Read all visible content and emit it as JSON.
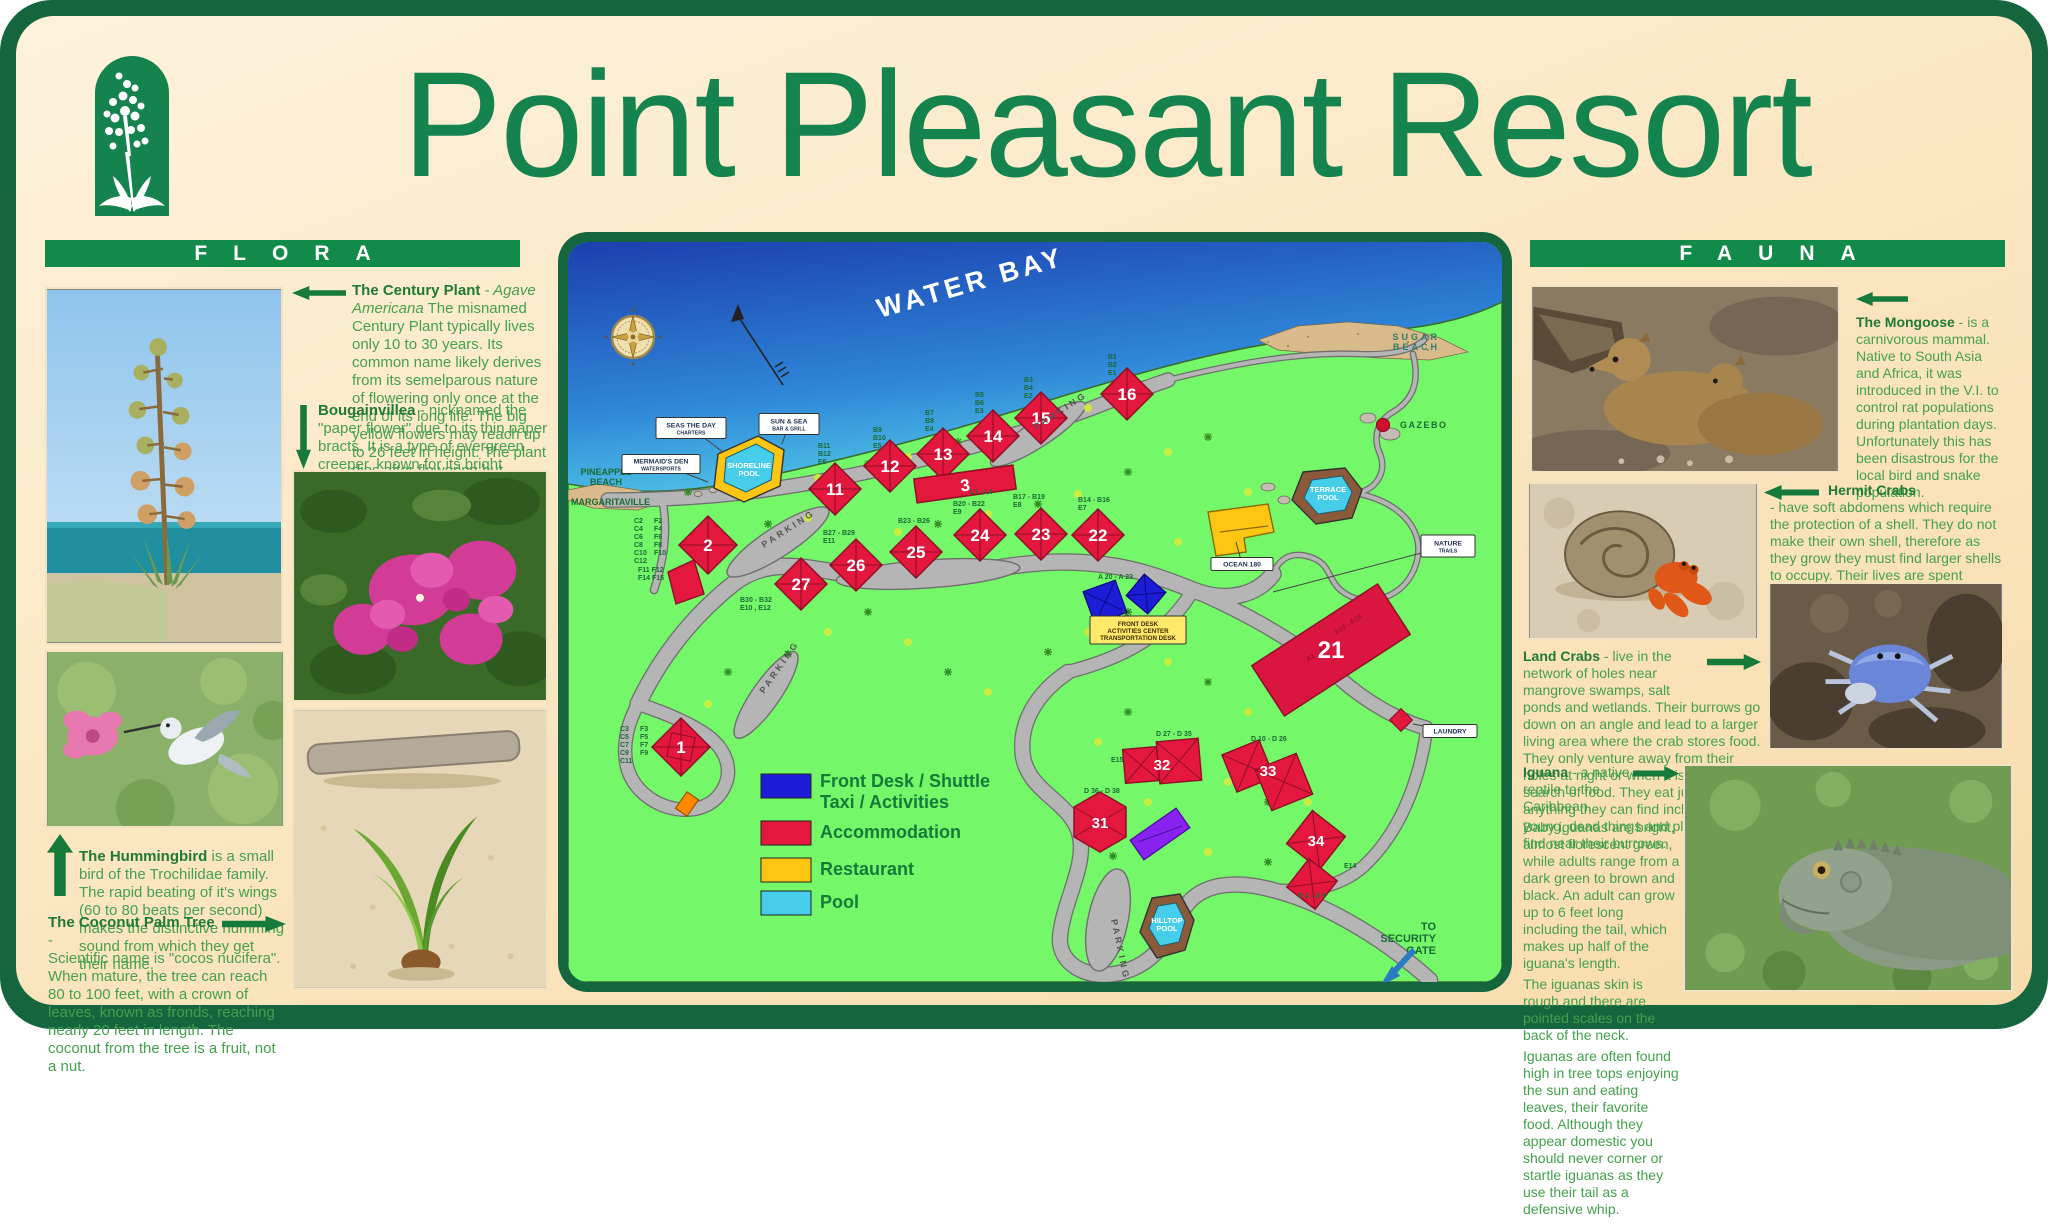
{
  "title": "Point Pleasant Resort",
  "colors": {
    "sign_green": "#15834e",
    "panel_cream": "#fbe7c4",
    "map_grass": "#74f768",
    "accommodation_red": "#e4173f",
    "front_desk_blue": "#1d1dd8",
    "restaurant_yellow": "#ffc513",
    "pool_cyan": "#45cdea"
  },
  "flora": {
    "heading": "FLORA",
    "century": {
      "name": "The Century Plant",
      "sci": "- Agave Americana",
      "body": "The misnamed Century Plant typically lives only 10 to 30 years. Its common name likely derives from its semelparous nature of flowering only once at the end of its long life. The big yellow flowers may reach up to 26 feet in height. The plant dies after flowering but produces adventitious shoots from the base, which continue its growth."
    },
    "bougainvillea": {
      "name": "Bougainvillea",
      "body": "- nicknamed the \"paper flower\" due to its thin paper bracts. It is a type of evergreen creeper, known for its bright blooms. With as many as 300 species, Bougainvillea thrives in sunlight, in tropical and subtropical conditions."
    },
    "hummingbird": {
      "name": "The Hummingbird",
      "body": "is a small bird of the Trochilidae family. The rapid beating of it's wings (60 to 80 beats per second) makes the distinctive humming sound from which they get their name."
    },
    "coconut": {
      "name": "The Coconut Palm Tree",
      "dash": "-",
      "body": "Scientific name is \"cocos nucifera\". When mature, the tree can reach 80 to 100 feet, with a crown of leaves, known as fronds, reaching nearly 20 feet in length. The coconut from the tree is a fruit, not a nut."
    }
  },
  "fauna": {
    "heading": "FAUNA",
    "mongoose": {
      "name": "The Mongoose",
      "body": "- is a carnivorous mammal. Native to South Asia and Africa, it was introduced in the V.I. to control rat populations during plantation days. Unfortunately this has been disastrous for the local bird and snake population."
    },
    "hermit": {
      "name": "Hermit Crabs",
      "body": "- have soft abdomens which require the protection of a shell. They do not make their own shell, therefore as they grow they must find larger shells to occupy. Their lives are spent  searching for and occupying shells of other animals. They are scavengers and their diet is varied - dead fish, algae, seaweeds, decaying fruit."
    },
    "landcrab": {
      "name": "Land Crabs",
      "body": "- live in the network of holes near mangrove swamps, salt ponds and wetlands. Their burrows go down on an angle and lead to a larger living area where the crab stores food. They only venture away from their holes at night or when it is raining in search of food. They eat just about anything they can find including their young, dead things and plants they find near their burrows."
    },
    "iguana": {
      "name": "Iguana",
      "intro": "- a native reptile to the Caribbean.",
      "p1": "Baby iguanas are bright, almost florescent green, while adults range from a dark green to brown and black. An adult  can grow up to 6 feet long including the tail, which makes up half of the iguana's length.",
      "p2": "The iguanas skin is rough and there are pointed scales on the back of the neck.",
      "p3": "Iguanas are often found high in tree tops enjoying the sun and eating leaves, their favorite food. Although they appear domestic you should never corner or startle iguanas as they use their tail as a defensive whip."
    }
  },
  "map": {
    "water_label": "WATER BAY",
    "diamond_numbers": [
      "11",
      "12",
      "13",
      "14",
      "15",
      "16",
      "22",
      "23",
      "24",
      "25",
      "26",
      "27",
      "2",
      "1"
    ],
    "rect_numbers": [
      "3",
      "21"
    ],
    "cluster_numbers": [
      "31",
      "32",
      "33",
      "34"
    ],
    "building21_units": [
      "A10 - A19",
      "A1 - A9"
    ],
    "unit_labels": [
      "B11\nB12\nE6",
      "B9\nB10\nE5",
      "B7\nB8\nE4",
      "B5\nB6\nE3",
      "B3\nB4\nE2",
      "B1\nB2\nE1",
      "L1 - L4",
      "B20 - B22\nE9",
      "B17 - B19\nE8",
      "B14 - B16\nE7",
      "B23 - B26",
      "B27 - B29\nE11",
      "B30 - B32\nE10 , E12",
      "C2\nC4\nC6\nC8\nC10\nC12",
      "F2\nF4\nF6\nF8\nF10",
      "F11  F12\nF14  F15",
      "C3\nC5\nC7\nC9\nC11",
      "F3\nF5\nF7\nF9",
      "A 20 - A 23",
      "D 27 - D 35",
      "D 10 - D 26",
      "E15",
      "D 36 - D 38",
      "E14",
      "D 1 - D 9"
    ],
    "place_labels": {
      "sugar_beach": "SUGAR\nBEACH",
      "pineapple_beach": "PINEAPPLE\nBEACH",
      "margaritaville": "MARGARITAVILLE",
      "gazebo": "GAZEBO",
      "parking": "PARKING",
      "security": "TO\nSECURITY\nGATE"
    },
    "boxes": {
      "seas": [
        "SEAS THE DAY",
        "CHARTERS"
      ],
      "sunsea": [
        "SUN & SEA",
        "BAR & GRILL"
      ],
      "mermaid": [
        "MERMAID'S DEN",
        "WATERSPORTS"
      ],
      "ocean180": [
        "OCEAN 180"
      ],
      "nature": [
        "NATURE",
        "TRAILS"
      ],
      "laundry": [
        "LAUNDRY"
      ],
      "frontdesk": [
        "FRONT DESK",
        "ACTIVITIES CENTER",
        "TRANSPORTATION DESK"
      ]
    },
    "pools": [
      "SHORELINE\nPOOL",
      "TERRACE\nPOOL",
      "HILLTOP\nPOOL"
    ],
    "legend": [
      {
        "label": "Front Desk / Shuttle\nTaxi / Activities",
        "color": "#1d1dd8"
      },
      {
        "label": "Accommodation",
        "color": "#e4173f"
      },
      {
        "label": "Restaurant",
        "color": "#ffc513"
      },
      {
        "label": "Pool",
        "color": "#45cdea"
      }
    ]
  }
}
